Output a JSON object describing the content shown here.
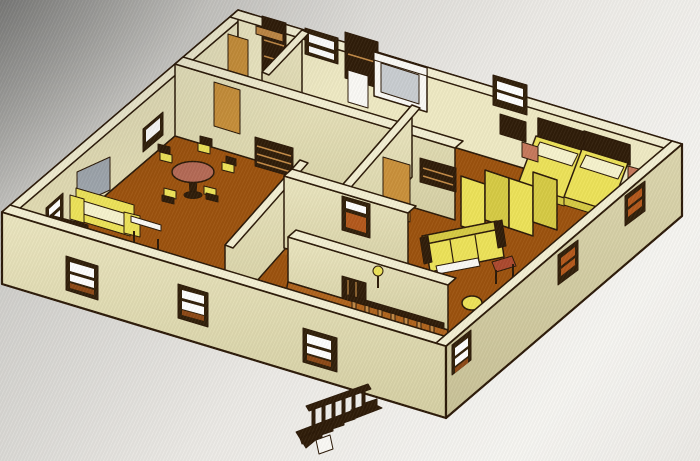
{
  "meta": {
    "title": "3D Floor Plan - Isometric View",
    "description": "Photographed computer screen showing a 3D isometric rendering of a furnished single-storey apartment floor plan with an exterior staircase at the front",
    "view": "isometric-3d",
    "visible_text": "none"
  },
  "colors": {
    "outline": "#2b1a09",
    "bg1": "#8f8f8d",
    "bg2": "#cfceca",
    "bg3": "#eceae6",
    "bg4": "#f7f6f2",
    "wall_top": "#f4f0d4",
    "wall_face": "#ebe6c2",
    "wall_face_dark": "#d6d0a6",
    "wall_face_r": "#ddd7b0",
    "wall_face_r_dark": "#c9c29a",
    "wall_inner": "#ece7c4",
    "wall_inner_dark": "#ddd6ae",
    "wall_inner_r": "#efeac6",
    "floor": "#9a5412",
    "floor_light": "#ad6521",
    "window_frame": "#31200b",
    "window_pane": "#ffffff",
    "window_pane_orange": "#b05a20",
    "window_sill": "#8a4a1a",
    "furniture_yellow": "#ece35f",
    "furniture_yellow_dark": "#d6cb4a",
    "cushion": "#f7f3cf",
    "wood": "#c18a4a",
    "wood_dark": "#2f1d0a",
    "door_tan": "#c8913f",
    "table_rose": "#b26b58",
    "salmon": "#c47a5e",
    "stool_red": "#a84a30",
    "gray_glass": "#9fa6ad",
    "shower_gray": "#c9cdd1",
    "white": "#fbfaf6"
  },
  "scene": {
    "building": {
      "storeys": 1,
      "wall_color_name": "cream",
      "floor_color_name": "terracotta brown",
      "orientation": "isometric aerial cutaway, roof removed, external staircase at front"
    },
    "rooms": [
      {
        "name": "living-dining-room",
        "position": "left",
        "furniture": [
          "round-dining-table",
          "dining-chairs-x5",
          "sofa",
          "armchair",
          "round-lounge-chair",
          "coffee-table",
          "gray-wall-panel"
        ]
      },
      {
        "name": "kitchen",
        "position": "back-left",
        "furniture": [
          "wall-shelf-planks",
          "tall-cabinet",
          "open-door"
        ]
      },
      {
        "name": "storage-room",
        "position": "back-middle",
        "furniture": [
          "dark-wardrobe",
          "white-cabinet"
        ]
      },
      {
        "name": "bathroom",
        "position": "back-center",
        "furniture": [
          "shower-cabin",
          "bath-mat"
        ]
      },
      {
        "name": "hallway",
        "position": "center",
        "furniture": [
          "bookshelf",
          "open-door"
        ]
      },
      {
        "name": "bedroom",
        "position": "right",
        "furniture": [
          "bed-1",
          "bed-2",
          "nightstand-1",
          "nightstand-2",
          "folding-screen-4-panel",
          "sideboard",
          "tv-cabinet"
        ]
      },
      {
        "name": "living-room",
        "position": "front-right",
        "furniture": [
          "sofa",
          "side-stool",
          "round-pouf"
        ]
      },
      {
        "name": "entry-porch",
        "position": "front-center",
        "furniture": [
          "balustrade-railing",
          "dark-gate",
          "lamp"
        ]
      }
    ],
    "windows": {
      "front_left_wall": 3,
      "front_right_wall": 3,
      "back_left_wall": 2,
      "back_right_wall": 2,
      "style": "dark brown frame with light panes and sill"
    },
    "doors": {
      "count": 3,
      "color_name": "tan wood"
    },
    "staircase": {
      "location": "front exterior",
      "steps": 7,
      "direction": "descending to lower-left",
      "railing": true
    }
  }
}
